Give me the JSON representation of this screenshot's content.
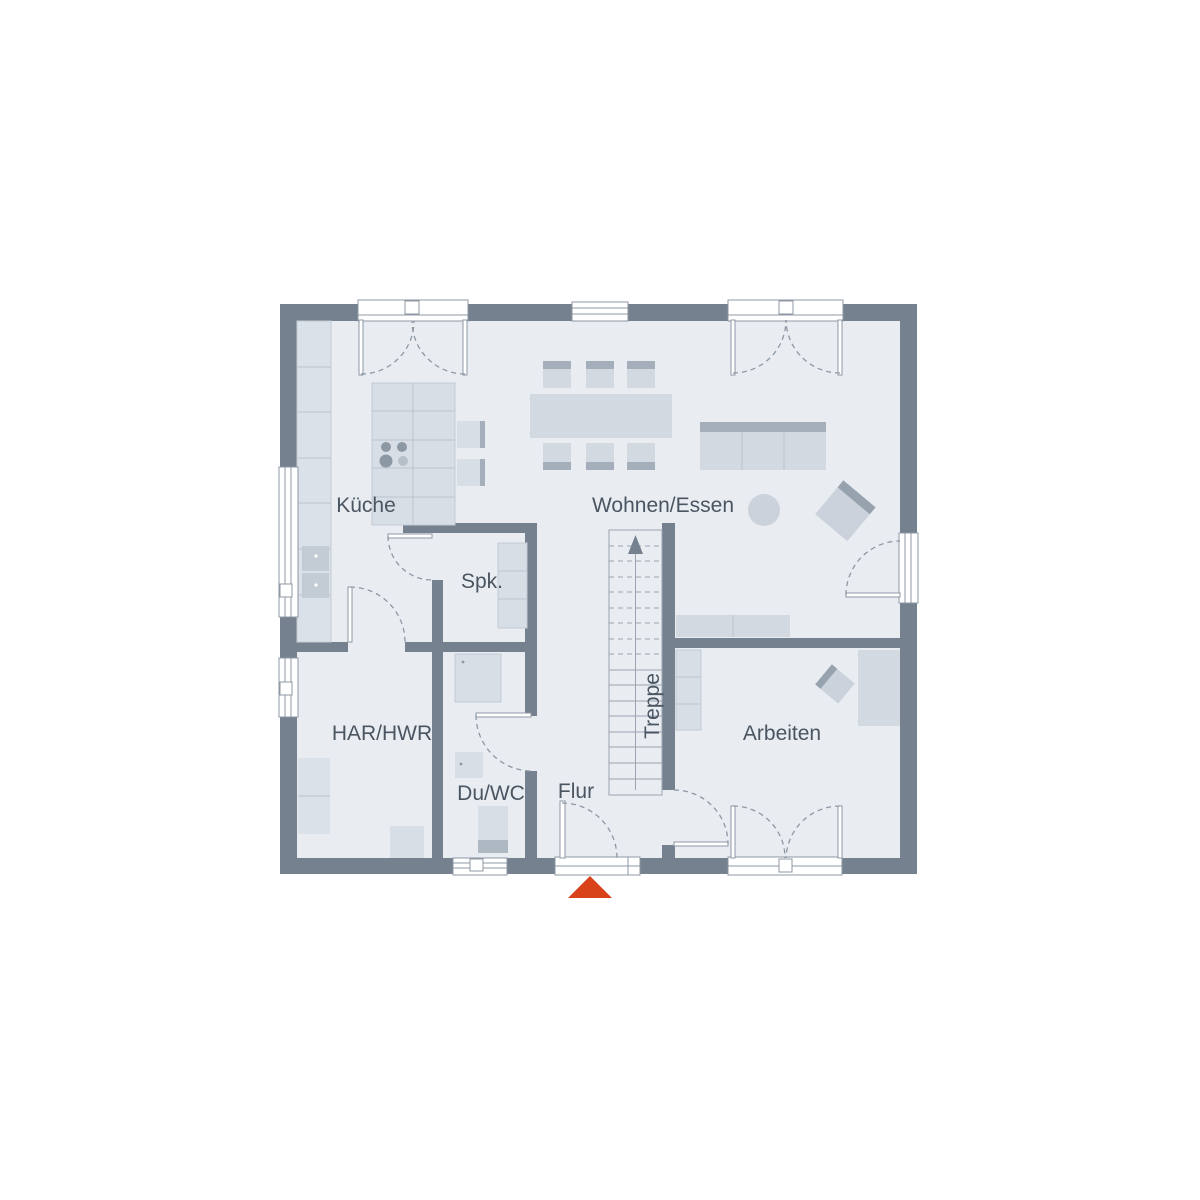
{
  "plan": {
    "type": "floor-plan",
    "rooms": [
      {
        "id": "kueche",
        "label": "Küche"
      },
      {
        "id": "wohnen-essen",
        "label": "Wohnen/Essen"
      },
      {
        "id": "spk",
        "label": "Spk."
      },
      {
        "id": "har-hwr",
        "label": "HAR/HWR"
      },
      {
        "id": "du-wc",
        "label": "Du/WC"
      },
      {
        "id": "flur",
        "label": "Flur"
      },
      {
        "id": "treppe",
        "label": "Treppe"
      },
      {
        "id": "arbeiten",
        "label": "Arbeiten"
      }
    ],
    "stairs": {
      "label": "Treppe",
      "direction": "up"
    },
    "icons": {
      "entrance_marker": "triangle-up"
    },
    "colors": {
      "background": "#FFFFFF",
      "wall": "#75818F",
      "floor": "#E9EDF2",
      "furniture": "#D3D9E1",
      "furniture_dark": "#A5AFBC",
      "outline": "#8D98A5",
      "label": "#4A5561",
      "entrance_marker": "#D9431C"
    }
  }
}
